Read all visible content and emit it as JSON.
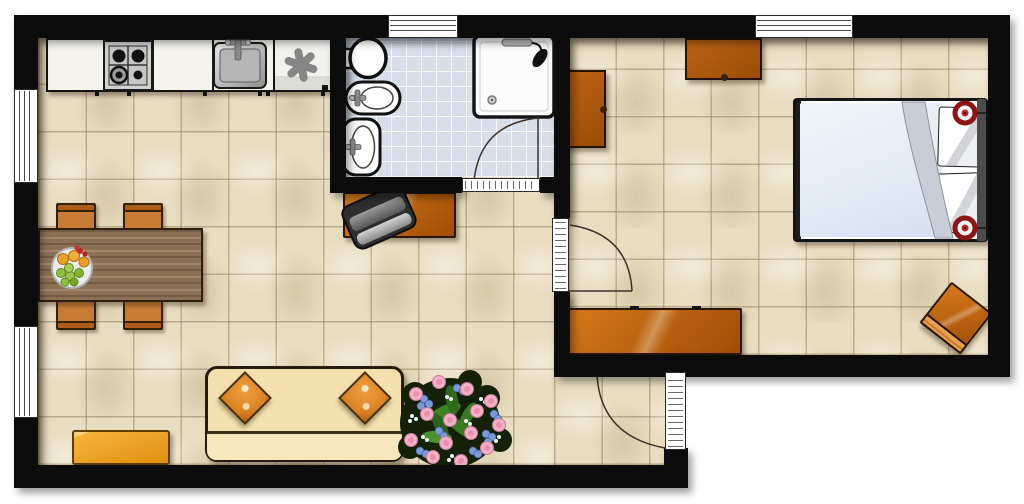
{
  "app": {
    "type": "floor-plan",
    "title": "One-bedroom apartment floor plan",
    "visible_text": "none"
  },
  "palette": {
    "wall": "#0c0c0c",
    "floor_living": "#e9ddc1",
    "floor_bath": "#d8dee9",
    "counter_white": "#f4f3ee",
    "furniture_orange_light": "#d5791c",
    "furniture_orange_dark": "#a04d05",
    "chair_orange": "#c97c34",
    "chair_back": "#ad5c1c",
    "wood_table": "#8b7056",
    "sofa_cream": "#f3e0ae",
    "cushion_orange": "#d98122",
    "bench_yellow": "#f2a52d",
    "bed_duvet": "#e2eaf4",
    "lamp_red": "#b92222",
    "leaf_green": "#3a7a22",
    "rose_pink": "#f3b1c8",
    "flower_blue": "#7b9ad8",
    "door_line": "#3d332a"
  },
  "rooms": [
    {
      "name": "kitchen-living-room",
      "floor": "beige-tile"
    },
    {
      "name": "bathroom",
      "floor": "blue-tile"
    },
    {
      "name": "bedroom",
      "floor": "beige-tile"
    }
  ],
  "openings": {
    "windows": [
      "left-wall-upper",
      "left-wall-lower",
      "bathroom-top",
      "bedroom-top"
    ],
    "doors": [
      "bathroom-door",
      "bedroom-door",
      "entrance-door"
    ]
  },
  "furniture": {
    "kitchen": [
      "counter",
      "gas-hob-4-burners",
      "kitchen-sink",
      "freezer"
    ],
    "living_room": [
      "dining-table",
      "chair-x4",
      "fruit-bowl",
      "sofa",
      "cushion-x2",
      "yellow-bench",
      "flower-bouquet",
      "desk",
      "office-chair"
    ],
    "bathroom": [
      "toilet",
      "bidet",
      "washbasin",
      "shower-cabin"
    ],
    "bedroom": [
      "double-bed",
      "pillow-x2",
      "reading-lamp-x2",
      "dresser",
      "wall-cabinet",
      "sideboard",
      "stool"
    ]
  }
}
